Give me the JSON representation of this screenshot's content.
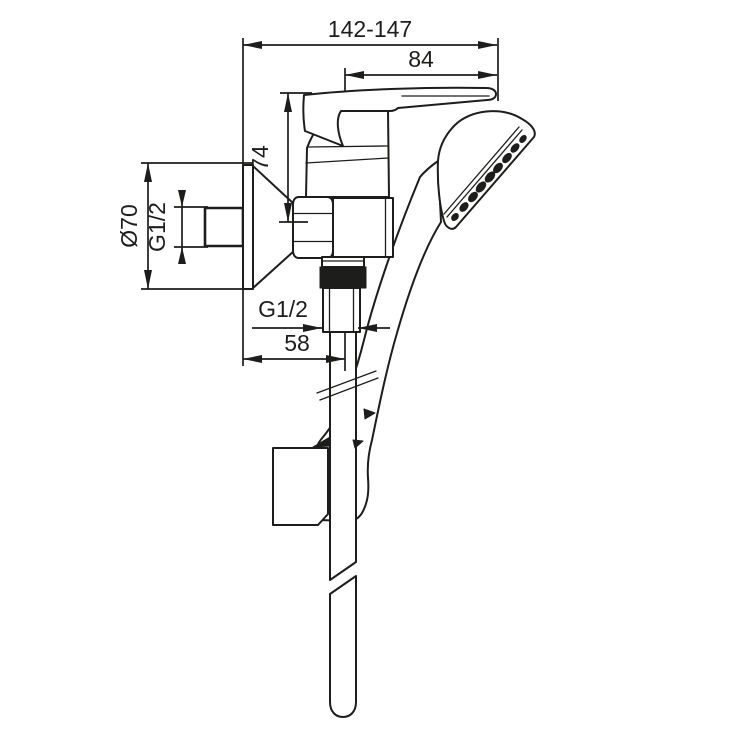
{
  "drawing": {
    "type": "technical-dimension-drawing",
    "subject": "wall-mounted single-lever shower mixer with hand shower and hose, side view",
    "background": "#ffffff",
    "ink_color": "#1d1d1b"
  },
  "annotations": {
    "width_overall": "142-147",
    "lever_length": "84",
    "lever_height": "74",
    "escutcheon_diameter": "Ø70",
    "inlet_thread": "G1/2",
    "hose_thread": "G1/2",
    "hose_offset": "58"
  }
}
